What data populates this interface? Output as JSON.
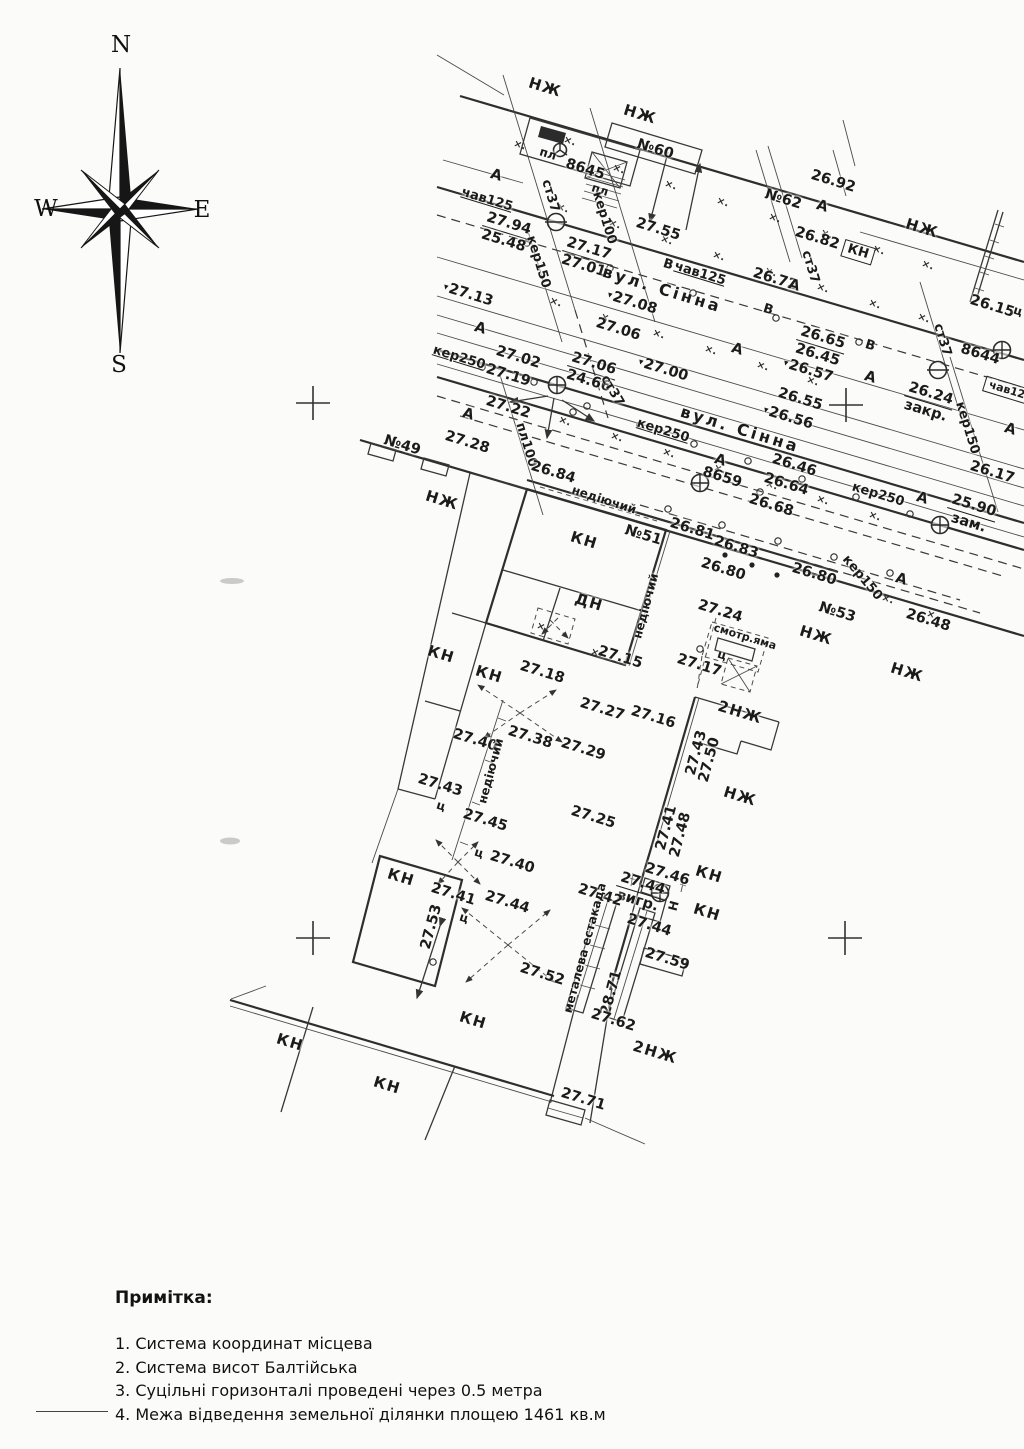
{
  "page": {
    "background": "#fbfbf9",
    "ink": "#333333"
  },
  "compass": {
    "n": "N",
    "s": "S",
    "e": "E",
    "w": "W"
  },
  "map": {
    "default_label_rotation_deg": 17,
    "labels": [
      {
        "t": "НЖ",
        "x": 545,
        "y": 88,
        "c": "bldg"
      },
      {
        "t": "НЖ",
        "x": 640,
        "y": 115,
        "c": "bldg"
      },
      {
        "t": "№60",
        "x": 655,
        "y": 150
      },
      {
        "t": "пл",
        "x": 548,
        "y": 154,
        "c": "sm"
      },
      {
        "t": "8645",
        "x": 585,
        "y": 170
      },
      {
        "t": "пл",
        "x": 600,
        "y": 190,
        "c": "sm"
      },
      {
        "t": "А",
        "x": 496,
        "y": 176
      },
      {
        "t": "чав125",
        "x": 487,
        "y": 200,
        "c": "u",
        "s": 13
      },
      {
        "t": "27.94",
        "b": "25.48",
        "x": 506,
        "y": 233
      },
      {
        "t": "ст37",
        "x": 550,
        "y": 196,
        "r": 73,
        "s": 13
      },
      {
        "t": "кер150",
        "x": 538,
        "y": 262,
        "r": 73,
        "s": 13
      },
      {
        "t": "кер100",
        "x": 604,
        "y": 218,
        "r": 73,
        "s": 13
      },
      {
        "t": "27.17",
        "b": "27.01",
        "x": 586,
        "y": 258
      },
      {
        "t": "27.55",
        "x": 658,
        "y": 230
      },
      {
        "t": "№62",
        "x": 783,
        "y": 200
      },
      {
        "t": "26.92",
        "x": 833,
        "y": 182
      },
      {
        "t": "А",
        "x": 822,
        "y": 207
      },
      {
        "t": "26.82",
        "x": 817,
        "y": 239
      },
      {
        "t": "КН",
        "x": 858,
        "y": 252,
        "c": "box",
        "s": 13
      },
      {
        "t": "НЖ",
        "x": 922,
        "y": 229,
        "c": "bldg"
      },
      {
        "t": "ст37",
        "x": 810,
        "y": 267,
        "r": 73,
        "s": 13
      },
      {
        "t": "26.72",
        "x": 775,
        "y": 280
      },
      {
        "t": "А",
        "x": 794,
        "y": 286
      },
      {
        "t": "В",
        "x": 768,
        "y": 310,
        "s": 13
      },
      {
        "t": "В",
        "x": 668,
        "y": 265,
        "s": 13
      },
      {
        "t": "чав125",
        "x": 700,
        "y": 274,
        "c": "u",
        "s": 13
      },
      {
        "t": "вул. Сінна",
        "x": 662,
        "y": 290,
        "c": "street"
      },
      {
        "t": "27.13",
        "x": 468,
        "y": 295,
        "tri": 1
      },
      {
        "t": "27.08",
        "x": 632,
        "y": 303,
        "tri": 1
      },
      {
        "t": "27.06",
        "x": 618,
        "y": 330
      },
      {
        "t": "А",
        "x": 480,
        "y": 329
      },
      {
        "t": "А",
        "x": 737,
        "y": 350
      },
      {
        "t": "26.65",
        "b": "26.45",
        "x": 820,
        "y": 347
      },
      {
        "t": "В",
        "x": 870,
        "y": 346,
        "s": 13
      },
      {
        "t": "ст37",
        "x": 942,
        "y": 340,
        "r": 73,
        "s": 13
      },
      {
        "t": "26.15",
        "x": 992,
        "y": 307
      },
      {
        "t": "ц",
        "x": 1018,
        "y": 311,
        "s": 12
      },
      {
        "t": "8644",
        "x": 980,
        "y": 355
      },
      {
        "t": "26.57",
        "x": 808,
        "y": 371,
        "tri": 1
      },
      {
        "t": "А",
        "x": 870,
        "y": 378
      },
      {
        "t": "26.24",
        "b": "закр.",
        "x": 928,
        "y": 403
      },
      {
        "t": "кер150",
        "x": 967,
        "y": 428,
        "r": 73,
        "s": 13
      },
      {
        "t": "кер250",
        "x": 459,
        "y": 358,
        "c": "u",
        "s": 13
      },
      {
        "t": "27.02",
        "x": 518,
        "y": 358
      },
      {
        "t": "27.19",
        "x": 508,
        "y": 376
      },
      {
        "t": "27.06",
        "b": "24.66",
        "x": 591,
        "y": 373
      },
      {
        "t": "ст37",
        "x": 612,
        "y": 391,
        "r": 60,
        "s": 13
      },
      {
        "t": "27.00",
        "x": 663,
        "y": 370,
        "tri": 1
      },
      {
        "t": "26.55",
        "x": 800,
        "y": 400
      },
      {
        "t": "26.56",
        "x": 788,
        "y": 418,
        "tri": 1
      },
      {
        "t": "вул. Сінна",
        "x": 740,
        "y": 430,
        "c": "street"
      },
      {
        "t": "27.22",
        "x": 508,
        "y": 408
      },
      {
        "t": "А",
        "x": 468,
        "y": 415
      },
      {
        "t": "А",
        "x": 1010,
        "y": 430
      },
      {
        "t": "26.17",
        "x": 992,
        "y": 473
      },
      {
        "t": "кер250",
        "x": 878,
        "y": 495,
        "s": 13
      },
      {
        "t": "А",
        "x": 922,
        "y": 499
      },
      {
        "t": "27.28",
        "x": 467,
        "y": 443
      },
      {
        "t": "№49",
        "x": 402,
        "y": 446
      },
      {
        "t": "пл100",
        "x": 526,
        "y": 445,
        "r": 73,
        "s": 13
      },
      {
        "t": "26.84",
        "x": 553,
        "y": 473
      },
      {
        "t": "26.46",
        "x": 794,
        "y": 466
      },
      {
        "t": "8659",
        "x": 722,
        "y": 478
      },
      {
        "t": "26.64",
        "x": 786,
        "y": 485
      },
      {
        "t": "А",
        "x": 720,
        "y": 461
      },
      {
        "t": "26.68",
        "x": 771,
        "y": 506
      },
      {
        "t": "25.90",
        "b": "зам.",
        "x": 971,
        "y": 515
      },
      {
        "t": "кер250",
        "x": 663,
        "y": 431,
        "c": "u",
        "s": 13
      },
      {
        "t": "НЖ",
        "x": 442,
        "y": 501,
        "c": "bldg"
      },
      {
        "t": "недіючий",
        "x": 604,
        "y": 500,
        "r": 18,
        "s": 12
      },
      {
        "t": "26.81",
        "x": 692,
        "y": 530
      },
      {
        "t": "№51",
        "x": 643,
        "y": 536
      },
      {
        "t": "26.83",
        "x": 736,
        "y": 548
      },
      {
        "t": "26.80",
        "x": 723,
        "y": 570
      },
      {
        "t": "26.80",
        "x": 814,
        "y": 575
      },
      {
        "t": "кер150",
        "x": 862,
        "y": 578,
        "r": 50,
        "s": 13
      },
      {
        "t": "А",
        "x": 901,
        "y": 580
      },
      {
        "t": "№53",
        "x": 837,
        "y": 613
      },
      {
        "t": "26.48",
        "x": 928,
        "y": 621
      },
      {
        "t": "НЖ",
        "x": 816,
        "y": 636,
        "c": "bldg"
      },
      {
        "t": "НЖ",
        "x": 907,
        "y": 673,
        "c": "bldg"
      },
      {
        "t": "КН",
        "x": 584,
        "y": 541,
        "c": "bldg"
      },
      {
        "t": "ДН",
        "x": 589,
        "y": 603,
        "c": "bldg"
      },
      {
        "t": "недіючий",
        "x": 646,
        "y": 606,
        "r": -75,
        "s": 12
      },
      {
        "t": "27.24",
        "x": 720,
        "y": 612
      },
      {
        "t": "смотр.яма",
        "x": 745,
        "y": 637,
        "s": 11
      },
      {
        "t": "ц",
        "x": 722,
        "y": 655,
        "s": 12
      },
      {
        "t": "27.17",
        "x": 699,
        "y": 666
      },
      {
        "t": "КН",
        "x": 441,
        "y": 655,
        "c": "bldg"
      },
      {
        "t": "КН",
        "x": 489,
        "y": 675,
        "c": "bldg"
      },
      {
        "t": "27.18",
        "x": 542,
        "y": 673
      },
      {
        "t": "27.15",
        "x": 620,
        "y": 658
      },
      {
        "t": "27.27",
        "x": 602,
        "y": 710
      },
      {
        "t": "27.16",
        "x": 653,
        "y": 718
      },
      {
        "t": "2НЖ",
        "x": 740,
        "y": 713,
        "c": "bldg"
      },
      {
        "t": "27.40",
        "x": 475,
        "y": 741
      },
      {
        "t": "27.38",
        "x": 530,
        "y": 738
      },
      {
        "t": "27.29",
        "x": 583,
        "y": 750
      },
      {
        "t": "недіючий",
        "x": 491,
        "y": 771,
        "r": -75,
        "s": 12
      },
      {
        "t": "27.43",
        "x": 440,
        "y": 786
      },
      {
        "t": "27.43",
        "x": 697,
        "y": 753,
        "r": -75
      },
      {
        "t": "27.50",
        "x": 710,
        "y": 760,
        "r": -75
      },
      {
        "t": "НЖ",
        "x": 740,
        "y": 797,
        "c": "bldg"
      },
      {
        "t": "ц",
        "x": 441,
        "y": 806,
        "s": 12
      },
      {
        "t": "27.45",
        "x": 485,
        "y": 821
      },
      {
        "t": "27.25",
        "x": 593,
        "y": 818
      },
      {
        "t": "27.41",
        "x": 667,
        "y": 828,
        "r": -75
      },
      {
        "t": "27.48",
        "x": 681,
        "y": 835,
        "r": -75
      },
      {
        "t": "ц",
        "x": 479,
        "y": 853,
        "s": 12
      },
      {
        "t": "27.40",
        "x": 512,
        "y": 863
      },
      {
        "t": "КН",
        "x": 401,
        "y": 878,
        "c": "bldg"
      },
      {
        "t": "27.41",
        "x": 453,
        "y": 895
      },
      {
        "t": "27.46",
        "x": 667,
        "y": 875
      },
      {
        "t": "27.44",
        "b": "вигр.",
        "x": 640,
        "y": 893
      },
      {
        "t": "27.53",
        "x": 432,
        "y": 927,
        "r": -75
      },
      {
        "t": "ц",
        "x": 464,
        "y": 918,
        "s": 12
      },
      {
        "t": "27.44",
        "x": 507,
        "y": 903
      },
      {
        "t": "27.42",
        "x": 600,
        "y": 896
      },
      {
        "t": "металева естакада",
        "x": 585,
        "y": 948,
        "r": -75,
        "s": 12
      },
      {
        "t": "27.44",
        "x": 649,
        "y": 926
      },
      {
        "t": "КН",
        "x": 709,
        "y": 875,
        "c": "bldg"
      },
      {
        "t": "Н",
        "x": 674,
        "y": 906,
        "r": -75,
        "s": 12
      },
      {
        "t": "КН",
        "x": 707,
        "y": 913,
        "c": "bldg"
      },
      {
        "t": "27.59",
        "x": 667,
        "y": 960
      },
      {
        "t": "27.52",
        "x": 542,
        "y": 975
      },
      {
        "t": "28.71",
        "x": 612,
        "y": 993,
        "r": -75
      },
      {
        "t": "КН",
        "x": 473,
        "y": 1021,
        "c": "bldg"
      },
      {
        "t": "27.62",
        "x": 613,
        "y": 1021
      },
      {
        "t": "2НЖ",
        "x": 655,
        "y": 1053,
        "c": "bldg"
      },
      {
        "t": "КН",
        "x": 290,
        "y": 1043,
        "c": "bldg"
      },
      {
        "t": "КН",
        "x": 387,
        "y": 1086,
        "c": "bldg"
      },
      {
        "t": "27.71",
        "x": 583,
        "y": 1100
      },
      {
        "t": "чав12",
        "x": 1007,
        "y": 390,
        "c": "box",
        "s": 11
      }
    ],
    "marks": {
      "crosses": [
        [
          313,
          403
        ],
        [
          846,
          405
        ],
        [
          313,
          938
        ],
        [
          845,
          938
        ]
      ],
      "xticks": [
        [
          513,
          146
        ],
        [
          563,
          142
        ],
        [
          612,
          170
        ],
        [
          664,
          186
        ],
        [
          716,
          203
        ],
        [
          768,
          219
        ],
        [
          820,
          235
        ],
        [
          872,
          251
        ],
        [
          921,
          266
        ],
        [
          556,
          209
        ],
        [
          608,
          225
        ],
        [
          660,
          241
        ],
        [
          712,
          257
        ],
        [
          764,
          273
        ],
        [
          816,
          289
        ],
        [
          868,
          305
        ],
        [
          917,
          319
        ],
        [
          549,
          303
        ],
        [
          600,
          319
        ],
        [
          652,
          335
        ],
        [
          704,
          351
        ],
        [
          756,
          367
        ],
        [
          806,
          382
        ],
        [
          558,
          422
        ],
        [
          610,
          438
        ],
        [
          662,
          454
        ],
        [
          713,
          470
        ],
        [
          765,
          486
        ],
        [
          816,
          501
        ],
        [
          868,
          517
        ],
        [
          881,
          600
        ],
        [
          926,
          616
        ],
        [
          590,
          654
        ],
        [
          536,
          628
        ]
      ],
      "circles": [
        [
          482,
          367
        ],
        [
          534,
          382
        ],
        [
          587,
          406
        ],
        [
          640,
          425
        ],
        [
          694,
          444
        ],
        [
          748,
          461
        ],
        [
          802,
          479
        ],
        [
          856,
          497
        ],
        [
          910,
          514
        ],
        [
          527,
          243
        ],
        [
          610,
          268
        ],
        [
          693,
          293
        ],
        [
          776,
          318
        ],
        [
          859,
          342
        ],
        [
          668,
          509
        ],
        [
          722,
          525
        ],
        [
          778,
          541
        ],
        [
          834,
          557
        ],
        [
          890,
          573
        ],
        [
          760,
          492
        ],
        [
          700,
          649
        ],
        [
          433,
          962
        ],
        [
          573,
          412
        ]
      ],
      "dots": [
        [
          725,
          555
        ],
        [
          752,
          565
        ],
        [
          777,
          575
        ]
      ],
      "symbols": [
        {
          "type": "circle-cross",
          "x": 557,
          "y": 385
        },
        {
          "type": "circle-cross",
          "x": 940,
          "y": 525
        },
        {
          "type": "circle-cross",
          "x": 1002,
          "y": 350
        },
        {
          "type": "circle-cross",
          "x": 660,
          "y": 893
        },
        {
          "type": "circle-cross",
          "x": 700,
          "y": 483
        },
        {
          "type": "circle-dash",
          "x": 556,
          "y": 222
        },
        {
          "type": "circle-dash",
          "x": 938,
          "y": 370
        },
        {
          "type": "hydrant",
          "x": 560,
          "y": 150
        }
      ]
    }
  },
  "notes": {
    "title": "Примітка:",
    "items": [
      "1. Система координат місцева",
      "2. Система висот Балтійська",
      "3. Суцільні горизонталі проведені через 0.5 метра",
      "4. Межа відведення земельної ділянки площею 1461 кв.м"
    ]
  }
}
